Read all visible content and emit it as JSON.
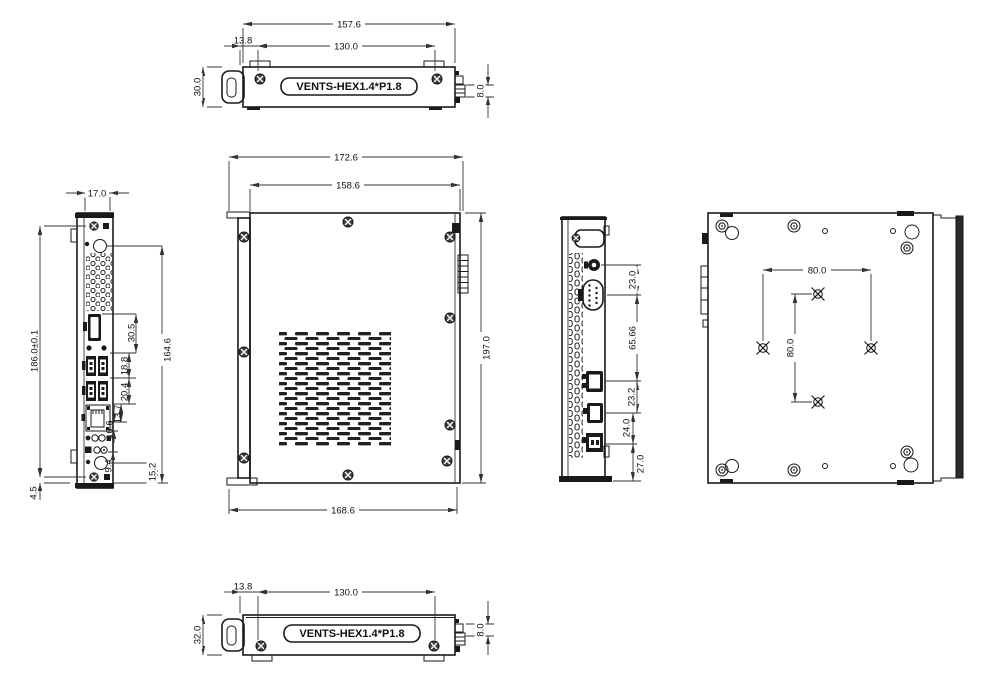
{
  "colors": {
    "line": "#1a1a1a",
    "background": "#ffffff"
  },
  "views": {
    "top_view": {
      "vents_label": "VENTS-HEX1.4*P1.8",
      "dims": {
        "overall_width": "157.6",
        "screw_offset": "13.8",
        "screw_spacing": "130.0",
        "depth": "30.0",
        "connector_height": "8.0"
      }
    },
    "front_view": {
      "dims": {
        "overall_width": "172.6",
        "body_width": "158.6",
        "overall_height": "197.0",
        "base_width": "168.6"
      }
    },
    "left_side_view": {
      "dims": {
        "thickness": "17.0",
        "overall_height": "186.0±0.1",
        "bottom_offset": "4.5",
        "io_span": "164.6",
        "dp_offset": "30.5",
        "usb_pitch": "18.8",
        "usb_lan_pitch": "20.4",
        "lan_audio_pitch": "13.7",
        "audio_pitch": "6.6",
        "led_pitch": "9.4",
        "power_offset": "15.2"
      }
    },
    "right_side_view": {
      "dims": {
        "dc_jack_offset": "23.0",
        "com_hdmi_span": "65.66",
        "hdmi_dp_pitch": "23.2",
        "dp_usb_pitch": "24.0",
        "usb_bottom_offset": "27.0"
      }
    },
    "back_view": {
      "dims": {
        "vesa_horizontal": "80.0",
        "vesa_vertical": "80.0"
      }
    },
    "bottom_view": {
      "vents_label": "VENTS-HEX1.4*P1.8",
      "dims": {
        "screw_offset": "13.8",
        "screw_spacing": "130.0",
        "depth": "32.0",
        "connector_height": "8.0"
      }
    }
  }
}
